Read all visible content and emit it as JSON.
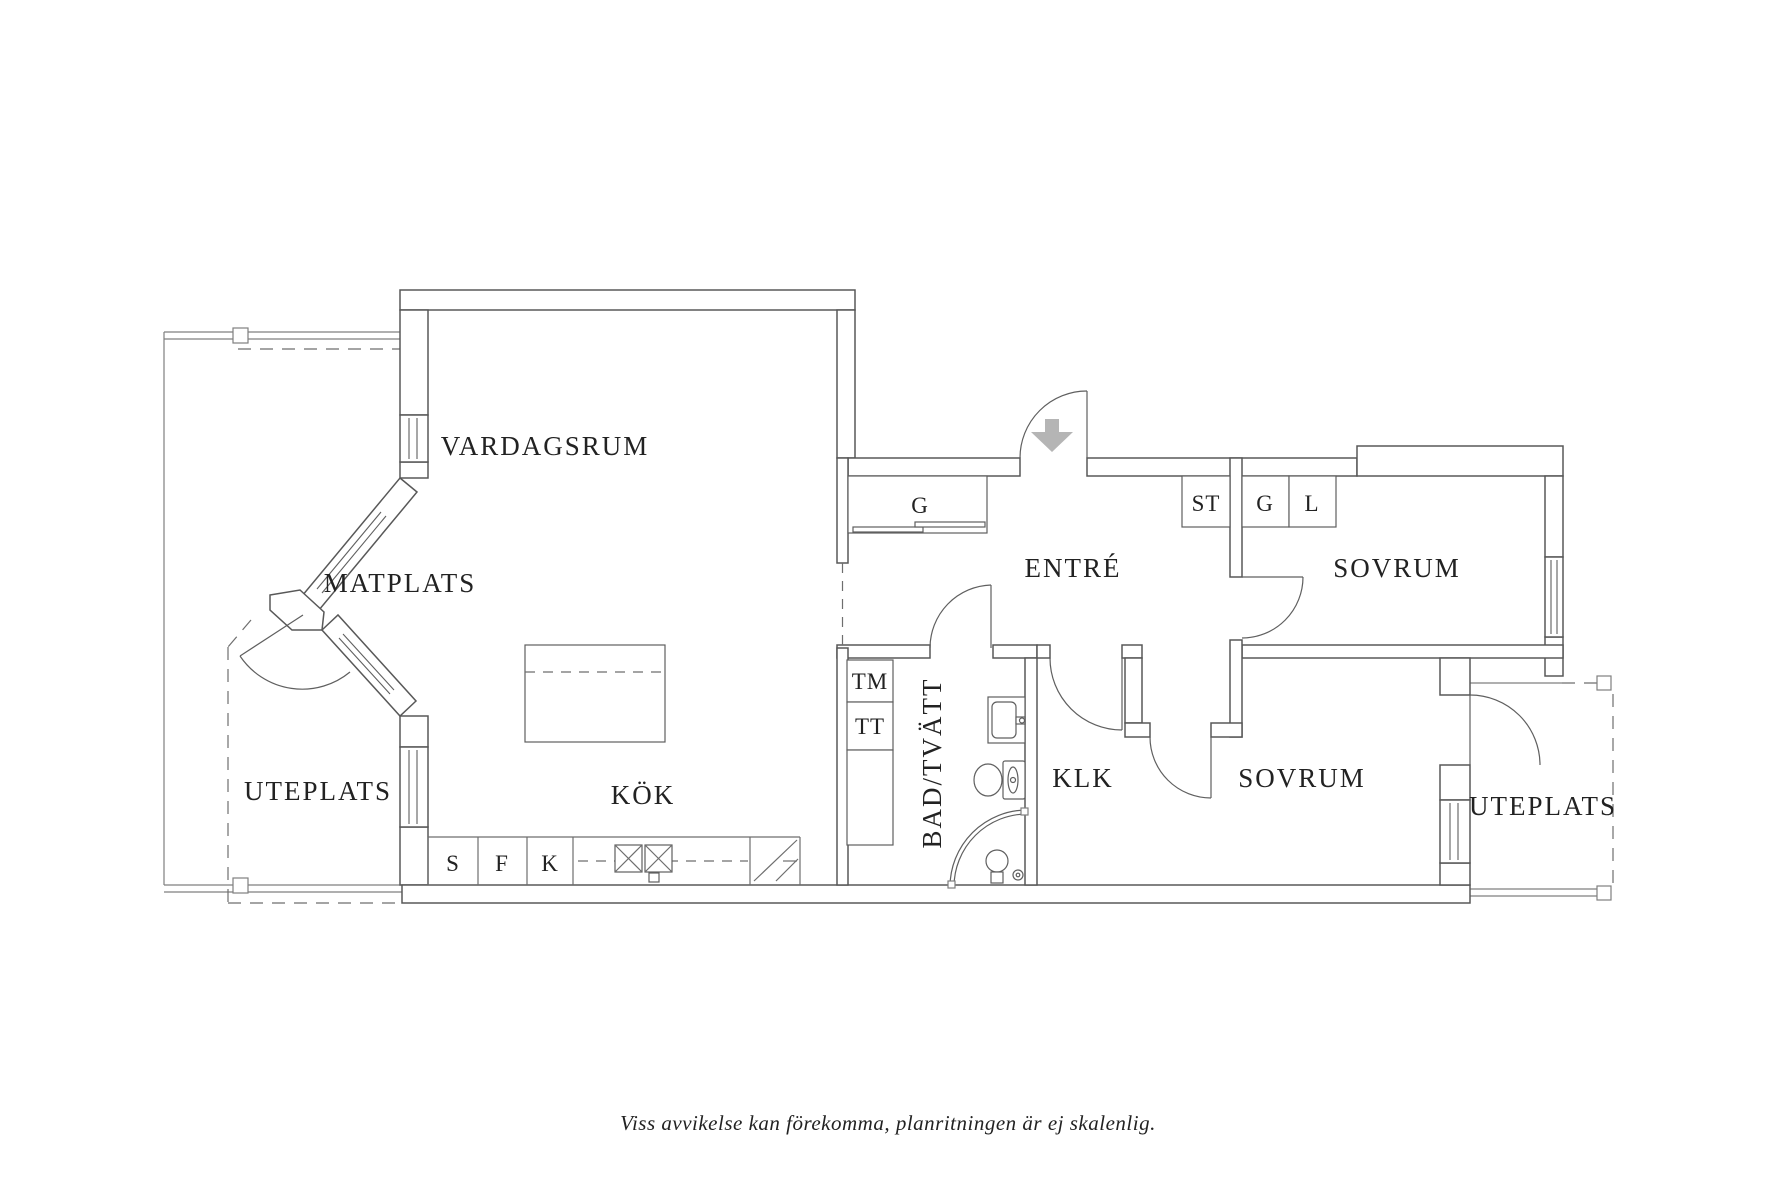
{
  "floorplan": {
    "labels": {
      "living": "VARDAGSRUM",
      "dining": "MATPLATS",
      "kitchen": "KÖK",
      "entry": "ENTRÉ",
      "bedroom_top": "SOVRUM",
      "bedroom_bottom": "SOVRUM",
      "bath": "BAD/TVÄTT",
      "closet": "KLK",
      "patio_left": "UTEPLATS",
      "patio_right": "UTEPLATS"
    },
    "cabinets": {
      "entry_wardrobe": "G",
      "st": "ST",
      "g": "G",
      "l": "L",
      "s": "S",
      "f": "F",
      "k": "K",
      "washer": "TM",
      "dryer": "TT"
    },
    "caption": "Viss avvikelse kan förekomma, planritningen är ej skalenlig.",
    "colors": {
      "wall_line": "#585858",
      "thin_line": "#7f7f7f",
      "label_text": "#222222",
      "entrance_arrow": "#b5b5b5",
      "background": "#ffffff"
    }
  }
}
